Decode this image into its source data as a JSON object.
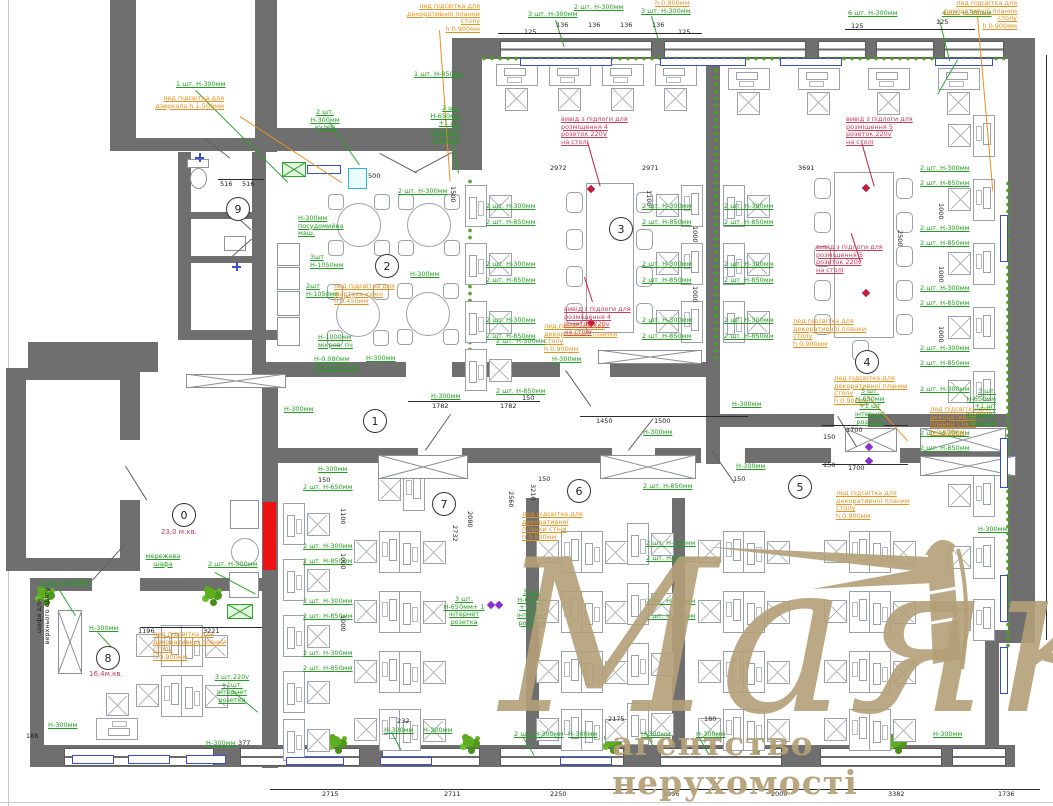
{
  "watermark": {
    "title": "Маяк",
    "subtitle": "агентство нерухомості",
    "color": "#b3a077"
  },
  "palette": {
    "wall_gray": "#6f6f6f",
    "furniture_gray": "#9aa1a8",
    "annotation_green": "#1f9e1f",
    "annotation_orange": "#e8911c",
    "annotation_red": "#cf3a56",
    "dimension_black": "#1d1d1d",
    "accent_blue": "#3a4ecc",
    "accent_cyan": "#2fb9cf",
    "plant_green": "#5fae1f",
    "cabinet_red": "#ee1111",
    "socket_purple": "#8a2fc9"
  },
  "rooms": [
    {
      "n": "9",
      "x": 237,
      "y": 208
    },
    {
      "n": "2",
      "x": 386,
      "y": 265
    },
    {
      "n": "3",
      "x": 620,
      "y": 228
    },
    {
      "n": "4",
      "x": 866,
      "y": 361
    },
    {
      "n": "1",
      "x": 374,
      "y": 420
    },
    {
      "n": "0",
      "x": 183,
      "y": 514,
      "area": "23,0 м.кв.",
      "ax": 161,
      "ay": 528
    },
    {
      "n": "7",
      "x": 443,
      "y": 503
    },
    {
      "n": "6",
      "x": 578,
      "y": 490
    },
    {
      "n": "5",
      "x": 799,
      "y": 486
    },
    {
      "n": "8",
      "x": 107,
      "y": 657,
      "area": "16,4м.кв.",
      "ax": 89,
      "ay": 670
    }
  ],
  "annotations": [
    {
      "t": "1 шт. Н-300мм",
      "c": "g",
      "x": 176,
      "y": 81
    },
    {
      "t": "лед підсвітка для\nдзеркала h 1.500мм",
      "c": "o",
      "x": 150,
      "y": 95,
      "w": 74,
      "a": "r"
    },
    {
      "t": "лед підсвітка для\nдекоративної планки столу\nh 0.900мм",
      "c": "o",
      "x": 386,
      "y": 3,
      "w": 94,
      "a": "r"
    },
    {
      "t": "1 шт. Н-850мм",
      "c": "g",
      "x": 414,
      "y": 71
    },
    {
      "t": "2 шт. Н-300мм\nкулер",
      "c": "g",
      "x": 301,
      "y": 109,
      "w": 48,
      "a": "c"
    },
    {
      "t": "2 шт. Н-650мм\n+1 шт\nінтернет\nрозетка",
      "c": "g",
      "x": 414,
      "y": 105,
      "w": 46,
      "a": "r"
    },
    {
      "t": "3 шт. Н-300мм",
      "c": "g",
      "x": 528,
      "y": 11
    },
    {
      "t": "2 шт. Н-300мм",
      "c": "g",
      "x": 574,
      "y": 4
    },
    {
      "t": "3 шт. Н-300мм",
      "c": "g",
      "x": 641,
      "y": 8
    },
    {
      "t": "h 0.900мм",
      "c": "o",
      "x": 655,
      "y": 0
    },
    {
      "t": "6 шт. Н-300мм",
      "c": "g",
      "x": 848,
      "y": 10
    },
    {
      "t": "4 шт. Н-300мм",
      "c": "g",
      "x": 942,
      "y": 10
    },
    {
      "t": "лед підсвітка для\nдекоративної планки столу\nh 0.900мм",
      "c": "o",
      "x": 925,
      "y": 0,
      "w": 92,
      "a": "r"
    },
    {
      "t": "2 шт. Н-300мм",
      "c": "g",
      "x": 398,
      "y": 188
    },
    {
      "t": "Н-300мм\nпосудомийна\nмаш.",
      "c": "g",
      "x": 298,
      "y": 215,
      "w": 44
    },
    {
      "t": "3шт\nН-1050мм",
      "c": "g",
      "x": 310,
      "y": 254
    },
    {
      "t": "2шт\nН-1050мм",
      "c": "g",
      "x": 306,
      "y": 283
    },
    {
      "t": "лед підсвітка для\nфартуха кухні\nh 0.450мм",
      "c": "o",
      "x": 334,
      "y": 283,
      "w": 62
    },
    {
      "t": "Н-1000мм\nмікров. пч",
      "c": "g",
      "x": 318,
      "y": 334
    },
    {
      "t": "Н-0.080мм\nхолодильник",
      "c": "g",
      "x": 314,
      "y": 356
    },
    {
      "t": "Н-300мм",
      "c": "g",
      "x": 410,
      "y": 271
    },
    {
      "t": "Н-300мм",
      "c": "g",
      "x": 366,
      "y": 355
    },
    {
      "t": "Н-300мм",
      "c": "g",
      "x": 284,
      "y": 406
    },
    {
      "t": "2 шт. Н-300мм",
      "c": "g",
      "x": 486,
      "y": 203
    },
    {
      "t": "2 шт. Н-850мм",
      "c": "g",
      "x": 486,
      "y": 219
    },
    {
      "t": "2 шт. Н-300мм",
      "c": "g",
      "x": 486,
      "y": 261
    },
    {
      "t": "2 шт. Н-850мм",
      "c": "g",
      "x": 486,
      "y": 277
    },
    {
      "t": "2 шт. Н-300мм",
      "c": "g",
      "x": 486,
      "y": 317
    },
    {
      "t": "2 шт. Н-850мм",
      "c": "g",
      "x": 486,
      "y": 333
    },
    {
      "t": "2 шт. Н-300мм",
      "c": "g",
      "x": 642,
      "y": 203
    },
    {
      "t": "2 шт. Н-850мм",
      "c": "g",
      "x": 642,
      "y": 219
    },
    {
      "t": "2 шт. Н-300мм",
      "c": "g",
      "x": 642,
      "y": 261
    },
    {
      "t": "2 шт. Н-850мм",
      "c": "g",
      "x": 642,
      "y": 277
    },
    {
      "t": "2 шт. Н-300мм",
      "c": "g",
      "x": 642,
      "y": 317
    },
    {
      "t": "2 шт. Н-850мм",
      "c": "g",
      "x": 642,
      "y": 333
    },
    {
      "t": "2 шт. Н-300мм",
      "c": "g",
      "x": 724,
      "y": 203
    },
    {
      "t": "2 шт. Н-850мм",
      "c": "g",
      "x": 724,
      "y": 219
    },
    {
      "t": "2 шт. Н-300мм",
      "c": "g",
      "x": 724,
      "y": 261
    },
    {
      "t": "2 шт. Н-850мм",
      "c": "g",
      "x": 724,
      "y": 277
    },
    {
      "t": "2 шт. Н-300мм",
      "c": "g",
      "x": 724,
      "y": 317
    },
    {
      "t": "2 шт. Н-850мм",
      "c": "g",
      "x": 724,
      "y": 333
    },
    {
      "t": "2 шт. Н-300мм",
      "c": "g",
      "x": 920,
      "y": 165
    },
    {
      "t": "2 шт. Н-850мм",
      "c": "g",
      "x": 920,
      "y": 180
    },
    {
      "t": "2 шт. Н-300мм",
      "c": "g",
      "x": 920,
      "y": 225
    },
    {
      "t": "2 шт. Н-850мм",
      "c": "g",
      "x": 920,
      "y": 240
    },
    {
      "t": "2 шт. Н-300мм",
      "c": "g",
      "x": 920,
      "y": 285
    },
    {
      "t": "2 шт. Н-850мм",
      "c": "g",
      "x": 920,
      "y": 300
    },
    {
      "t": "2 шт. Н-300мм",
      "c": "g",
      "x": 920,
      "y": 345
    },
    {
      "t": "2 шт. Н-850мм",
      "c": "g",
      "x": 920,
      "y": 360
    },
    {
      "t": "2 шт. Н-300мм",
      "c": "g",
      "x": 920,
      "y": 430
    },
    {
      "t": "2 шт. Н-850мм",
      "c": "g",
      "x": 920,
      "y": 445
    },
    {
      "t": "вивід з підлоги для\nрозміщення 4 розеток 220V\nна столі",
      "c": "r",
      "x": 561,
      "y": 116,
      "w": 68
    },
    {
      "t": "вивід з підлоги для\nрозміщення 4 розеток 220v\nна столі",
      "c": "r",
      "x": 564,
      "y": 306,
      "w": 68
    },
    {
      "t": "вивід з підлоги для\nрозміщення 5 розеток 220v\nна столі",
      "c": "r",
      "x": 846,
      "y": 116,
      "w": 68
    },
    {
      "t": "вивід з підлоги для\nрозміщення 5 розеток 220v\nна столі",
      "c": "r",
      "x": 816,
      "y": 244,
      "w": 68
    },
    {
      "t": "лед підсвітка для\nдекоративної планки столу\nh 0.900мм",
      "c": "o",
      "x": 544,
      "y": 323,
      "w": 86
    },
    {
      "t": "лед підсвітка для\nдекоративної планки столу\nh 0.900мм",
      "c": "o",
      "x": 793,
      "y": 318,
      "w": 86
    },
    {
      "t": "лед підсвітка для\nдекоративної планки столу\nh 0.900мм",
      "c": "o",
      "x": 834,
      "y": 375,
      "w": 88
    },
    {
      "t": "3 шт. Н-650мм\n+1 шт\nінтернет\nрозетка",
      "c": "g",
      "x": 846,
      "y": 388,
      "w": 48,
      "a": "c"
    },
    {
      "t": "лед підсвітка для\nдекоративної планки столу\nh 0.900мм",
      "c": "o",
      "x": 930,
      "y": 406,
      "w": 64
    },
    {
      "t": "лед підсвітка для\nдекоративної планки столу\nh 0.900мм",
      "c": "o",
      "x": 836,
      "y": 490,
      "w": 86
    },
    {
      "t": "лед підсвітка для\nдекоративної планки стіни\nh 0.900мм",
      "c": "o",
      "x": 522,
      "y": 511,
      "w": 72
    },
    {
      "t": "лед підсвітка для\nдекоративної планки столу\nh 0.900мм",
      "c": "o",
      "x": 153,
      "y": 631,
      "w": 84
    },
    {
      "t": "Н-300мм",
      "c": "g",
      "x": 732,
      "y": 401
    },
    {
      "t": "Н-300мм",
      "c": "g",
      "x": 643,
      "y": 429
    },
    {
      "t": "Н-300мм",
      "c": "g",
      "x": 736,
      "y": 463
    },
    {
      "t": "Н-300мм",
      "c": "g",
      "x": 431,
      "y": 393
    },
    {
      "t": "2 шт. Н-850мм",
      "c": "g",
      "x": 496,
      "y": 388
    },
    {
      "t": "2 шт. Н-300мм",
      "c": "g",
      "x": 496,
      "y": 338
    },
    {
      "t": "Н-300мм",
      "c": "g",
      "x": 552,
      "y": 356
    },
    {
      "t": "2 шт. Н-850мм",
      "c": "g",
      "x": 643,
      "y": 483
    },
    {
      "t": "2 шт. Н-300мм",
      "c": "g",
      "x": 646,
      "y": 540
    },
    {
      "t": "2 шт. Н-850мм",
      "c": "g",
      "x": 646,
      "y": 555
    },
    {
      "t": "2 шт. Н-300мм",
      "c": "g",
      "x": 646,
      "y": 598
    },
    {
      "t": "2 шт. Н-850мм",
      "c": "g",
      "x": 646,
      "y": 613
    },
    {
      "t": "Н-300мм",
      "c": "g",
      "x": 318,
      "y": 466
    },
    {
      "t": "2 шт. Н-650мм",
      "c": "g",
      "x": 303,
      "y": 484
    },
    {
      "t": "2 шт. Н-300мм",
      "c": "g",
      "x": 303,
      "y": 543
    },
    {
      "t": "2 шт. Н-850мм",
      "c": "g",
      "x": 303,
      "y": 558
    },
    {
      "t": "2 шт. Н-300мм",
      "c": "g",
      "x": 303,
      "y": 598
    },
    {
      "t": "2 шт. Н-850мм",
      "c": "g",
      "x": 303,
      "y": 613
    },
    {
      "t": "2 шт. Н-300мм",
      "c": "g",
      "x": 303,
      "y": 650
    },
    {
      "t": "2 шт. Н-850мм",
      "c": "g",
      "x": 303,
      "y": 665
    },
    {
      "t": "3 шт.\nН-650мм+ 1\nінтернет\nрозетка",
      "c": "g",
      "x": 443,
      "y": 596,
      "w": 42,
      "a": "c"
    },
    {
      "t": "3 шт.\nН-650мм\n+ 1 шт.\nінтернет\nрозетка",
      "c": "g",
      "x": 514,
      "y": 589,
      "w": 36,
      "a": "c"
    },
    {
      "t": "мережева\nшафа",
      "c": "g",
      "x": 145,
      "y": 553,
      "w": 36,
      "a": "c"
    },
    {
      "t": "2 шт. Н-300мм",
      "c": "g",
      "x": 208,
      "y": 561
    },
    {
      "t": "1 шт. Н-300мм",
      "c": "g",
      "x": 40,
      "y": 579
    },
    {
      "t": "Н-300мм",
      "c": "g",
      "x": 89,
      "y": 625
    },
    {
      "t": "3 шт.220v\n+1шт.\nінтернет\nрозетка",
      "c": "g",
      "x": 211,
      "y": 674,
      "w": 42,
      "a": "c"
    },
    {
      "t": "Н-300мм",
      "c": "g",
      "x": 206,
      "y": 740
    },
    {
      "t": "Н-300мм",
      "c": "g",
      "x": 48,
      "y": 722
    },
    {
      "t": "2 шт. Н-300мм",
      "c": "g",
      "x": 920,
      "y": 386
    },
    {
      "t": "3 шт. Н-650мм\n+1 шт\nінтернет\nрозетка",
      "c": "g",
      "x": 952,
      "y": 388,
      "w": 44,
      "a": "r"
    },
    {
      "t": "Н-300мм",
      "c": "g",
      "x": 978,
      "y": 526
    },
    {
      "t": "Н-300мм",
      "c": "g",
      "x": 384,
      "y": 727
    },
    {
      "t": "Н-300мм",
      "c": "g",
      "x": 423,
      "y": 727
    },
    {
      "t": "2 шт. Н-300мм",
      "c": "g",
      "x": 514,
      "y": 731
    },
    {
      "t": "Н-300мм",
      "c": "g",
      "x": 568,
      "y": 731
    },
    {
      "t": "Н-300мм",
      "c": "g",
      "x": 641,
      "y": 731
    },
    {
      "t": "Н-300мм",
      "c": "g",
      "x": 696,
      "y": 731
    },
    {
      "t": "Н-300мм",
      "c": "g",
      "x": 933,
      "y": 731
    },
    {
      "t": "шафа для\nверхнього одягу",
      "c": "k",
      "x": 36,
      "y": 648,
      "w": 64,
      "a": "c",
      "r": -90
    }
  ],
  "dimensions": [
    [
      "125",
      524,
      29
    ],
    [
      "136",
      556,
      22
    ],
    [
      "136",
      588,
      22
    ],
    [
      "136",
      620,
      22
    ],
    [
      "136",
      652,
      22
    ],
    [
      "125",
      678,
      29
    ],
    [
      "125",
      851,
      23
    ],
    [
      "125",
      936,
      19
    ],
    [
      "516",
      220,
      181
    ],
    [
      "516",
      242,
      181
    ],
    [
      "500",
      368,
      173
    ],
    [
      "2972",
      550,
      165
    ],
    [
      "2971",
      642,
      165
    ],
    [
      "3691",
      798,
      165
    ],
    [
      "1782",
      432,
      403
    ],
    [
      "1782",
      500,
      403
    ],
    [
      "150",
      522,
      395
    ],
    [
      "1450",
      596,
      418
    ],
    [
      "1500",
      654,
      418
    ],
    [
      "1700",
      846,
      427
    ],
    [
      "150",
      823,
      434
    ],
    [
      "1700",
      848,
      465
    ],
    [
      "150",
      823,
      462
    ],
    [
      "150",
      318,
      477
    ],
    [
      "150",
      538,
      476
    ],
    [
      "150",
      733,
      476
    ],
    [
      "232",
      397,
      718
    ],
    [
      "2175",
      608,
      716
    ],
    [
      "180",
      704,
      716
    ],
    [
      "2715",
      322,
      791
    ],
    [
      "2711",
      444,
      791
    ],
    [
      "2250",
      550,
      791
    ],
    [
      "2996",
      663,
      791
    ],
    [
      "2000",
      771,
      791
    ],
    [
      "3382",
      888,
      791
    ],
    [
      "1736",
      998,
      791
    ],
    [
      "1196",
      138,
      628
    ],
    [
      "3221",
      203,
      628
    ],
    [
      "188",
      26,
      733
    ],
    [
      "377",
      238,
      740
    ],
    [
      "1500",
      456,
      186,
      90
    ],
    [
      "2500",
      903,
      230,
      90
    ],
    [
      "3210",
      536,
      484,
      90
    ],
    [
      "2560",
      514,
      491,
      90
    ],
    [
      "2080",
      473,
      511,
      90
    ],
    [
      "2732",
      458,
      525,
      90
    ],
    [
      "1000",
      698,
      226,
      90
    ],
    [
      "1000",
      698,
      286,
      90
    ],
    [
      "1000",
      944,
      203,
      90
    ],
    [
      "1000",
      944,
      266,
      90
    ],
    [
      "1000",
      944,
      326,
      90
    ],
    [
      "1000",
      346,
      553,
      90
    ],
    [
      "1000",
      346,
      615,
      90
    ],
    [
      "1100",
      652,
      190,
      90
    ],
    [
      "1100",
      346,
      508,
      90
    ]
  ]
}
